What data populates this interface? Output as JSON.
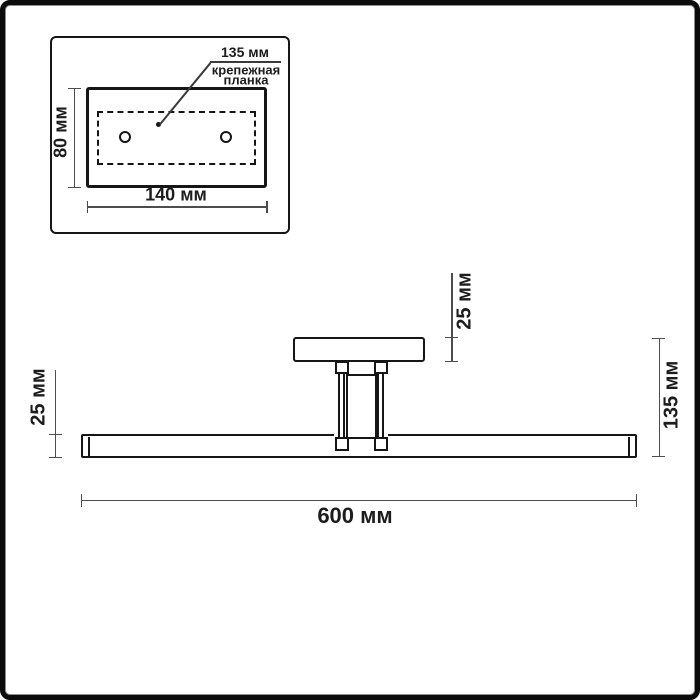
{
  "inset": {
    "hole_spacing_label": "135 мм",
    "plate_label_line1": "крепежная",
    "plate_label_line2": "планка",
    "height_label": "80 мм",
    "width_label": "140 мм"
  },
  "fixture": {
    "canopy_depth_label": "25 мм",
    "bar_height_label": "25 мм",
    "total_depth_label": "135 мм",
    "length_label": "600 мм"
  },
  "colors": {
    "object_line": "#161616",
    "dimension_line": "#4d4d4d",
    "background": "#ffffff",
    "frame_border": "#0b0b0b"
  }
}
